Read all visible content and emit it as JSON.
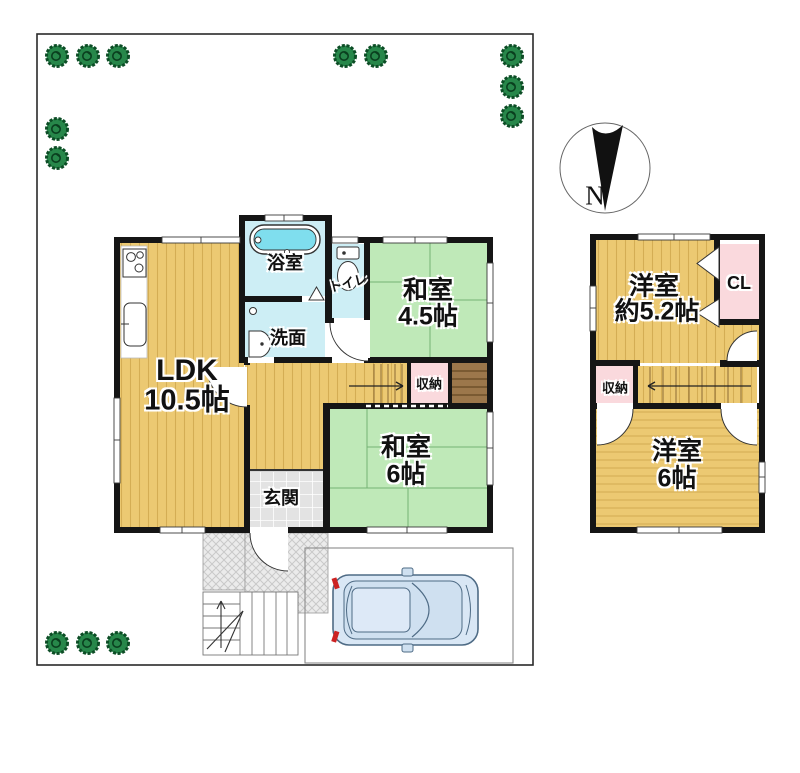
{
  "compass": {
    "north_label": "N"
  },
  "floor1": {
    "ldk": {
      "name": "LDK",
      "area": "10.5帖"
    },
    "bathroom": {
      "name": "浴室"
    },
    "toilet": {
      "name": "トイレ"
    },
    "washroom": {
      "name": "洗面"
    },
    "washitsu_4_5": {
      "name": "和室",
      "area": "4.5帖"
    },
    "washitsu_6": {
      "name": "和室",
      "area": "6帖"
    },
    "storage": {
      "name": "収納"
    },
    "entrance": {
      "name": "玄関"
    }
  },
  "floor2": {
    "youshitsu_5_2": {
      "name": "洋室",
      "area": "約5.2帖"
    },
    "closet": {
      "name": "CL"
    },
    "storage": {
      "name": "収納"
    },
    "youshitsu_6": {
      "name": "洋室",
      "area": "6帖"
    }
  },
  "colors": {
    "wall": "#151515",
    "wood_floor": "#ecc972",
    "wood_stripe": "#c49a3f",
    "tatami_green": "#bfe9b8",
    "tatami_line": "#74b274",
    "water_floor": "#cdeef5",
    "bathtub_cyan": "#7fdeee",
    "storage_pink": "#fad9dd",
    "closet_brown": "#9c774b",
    "entrance_tile": "#e3e3e3",
    "tree_green": "#27874a",
    "car_body": "#d9e7f5",
    "taillight_red": "#cc2222"
  }
}
